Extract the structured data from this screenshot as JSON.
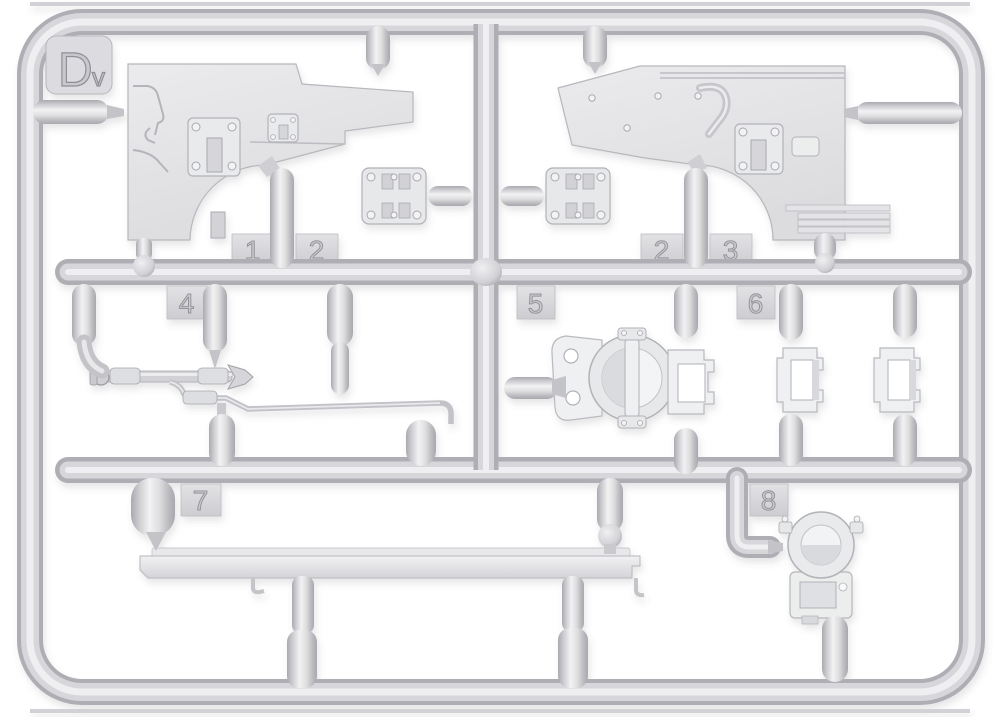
{
  "photo": {
    "type": "model-kit-sprue-photo",
    "description": "Light gray injection-molded polystyrene sprue (runner frame) of a scale model kit, photographed on a white background. Rounded rectangular outer runner with two horizontal cross-runners and one vertical runner; parts attached by gates.",
    "sprue_letter_main": "D",
    "sprue_letter_sub": "v",
    "background_color": "#ffffff",
    "plastic_base_color": "#d6d6da",
    "plastic_highlight_color": "#f1f1f3",
    "plastic_shadow_color": "#a9a9af"
  },
  "tags": {
    "t1": "1",
    "t2a": "2",
    "t2b": "2",
    "t3": "3",
    "t4": "4",
    "t5": "5",
    "t6": "6",
    "t7": "7",
    "t8": "8"
  },
  "visible_parts": [
    "left fender panel with bolted plates",
    "right fender panel with rivets, grab handle and bolted plate",
    "two hinge plates with bolt heads",
    "four thin strips",
    "linkage rod with arrow-shaped tip",
    "long thin bent rod",
    "pulley clamp with holed plate and bracket",
    "two rectangular brackets",
    "long brace strip",
    "round idler / pulley housing on bracket base"
  ]
}
